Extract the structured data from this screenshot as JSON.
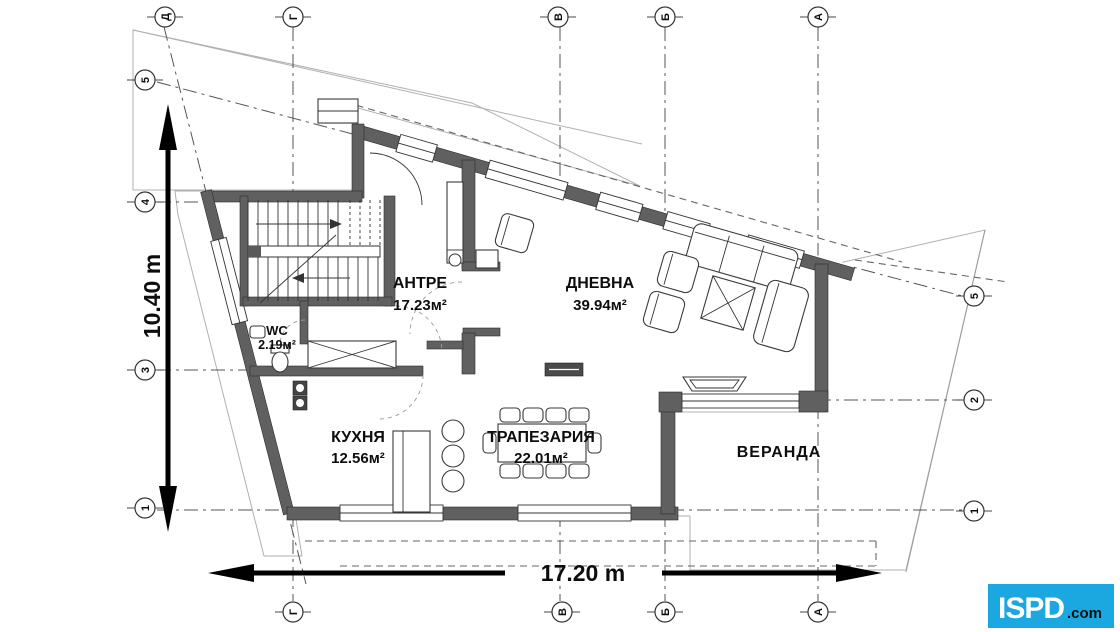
{
  "rooms": [
    {
      "name": "АНТРЕ",
      "area": "17.23м²"
    },
    {
      "name": "ДНЕВНА",
      "area": "39.94м²"
    },
    {
      "name": "WC",
      "area": "2.19м²"
    },
    {
      "name": "КУХНЯ",
      "area": "12.56м²"
    },
    {
      "name": "ТРАПЕЗАРИЯ",
      "area": "22.01м²"
    },
    {
      "name": "ВЕРАНДА",
      "area": ""
    }
  ],
  "dimensions": {
    "width": "17.20 m",
    "height": "10.40 m"
  },
  "axes": {
    "top": [
      "Д",
      "Г",
      "В",
      "Б",
      "А"
    ],
    "bottom": [
      "Г",
      "В",
      "Б",
      "А"
    ],
    "left": [
      "5",
      "4",
      "3",
      "1"
    ],
    "right": [
      "5",
      "2",
      "1"
    ]
  },
  "logo": {
    "text": "ISPD",
    "suffix": ".com",
    "bg_color": "#1BA8E1",
    "text_color": "#ffffff",
    "suffix_color": "#16324F"
  }
}
